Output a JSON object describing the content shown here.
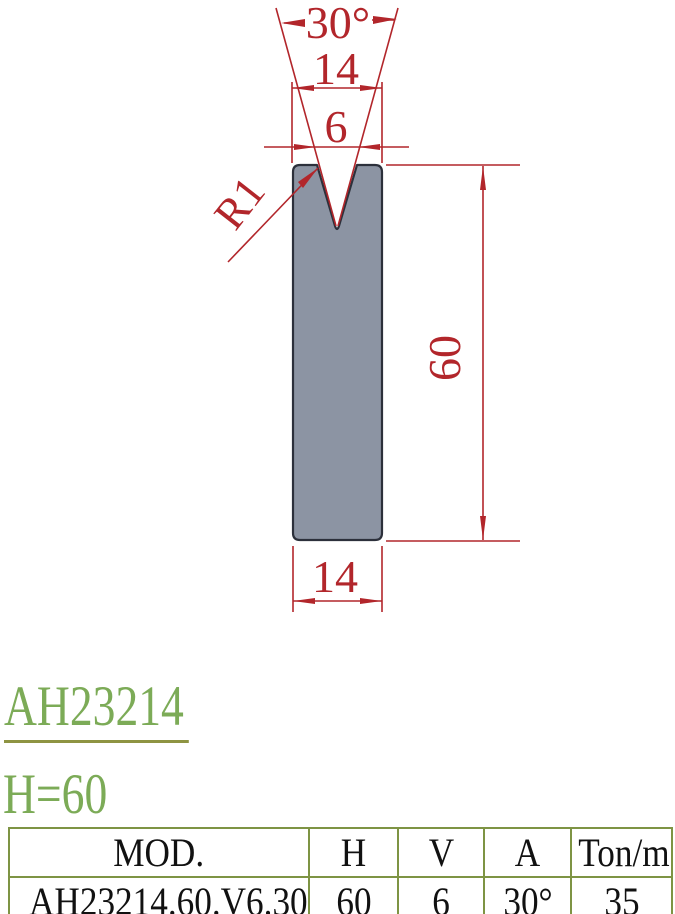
{
  "drawing": {
    "angle_label": "30°",
    "top_width_label": "14",
    "vee_opening_label": "6",
    "radius_label": "R1",
    "height_label": "60",
    "bottom_width_label": "14",
    "colors": {
      "dimension_red": "#b2262b",
      "die_fill": "#8c94a3",
      "die_stroke": "#2c303b"
    }
  },
  "titles": {
    "model": "AH23214",
    "height": "H=60",
    "title_green": "#7cab57",
    "underline_color": "#8e9442"
  },
  "table": {
    "border_color": "#7e9444",
    "headers": [
      "MOD.",
      "H",
      "V",
      "A",
      "Ton/m"
    ],
    "rows": [
      [
        "AH23214.60.V6.30",
        "60",
        "6",
        "30°",
        "35"
      ]
    ]
  }
}
